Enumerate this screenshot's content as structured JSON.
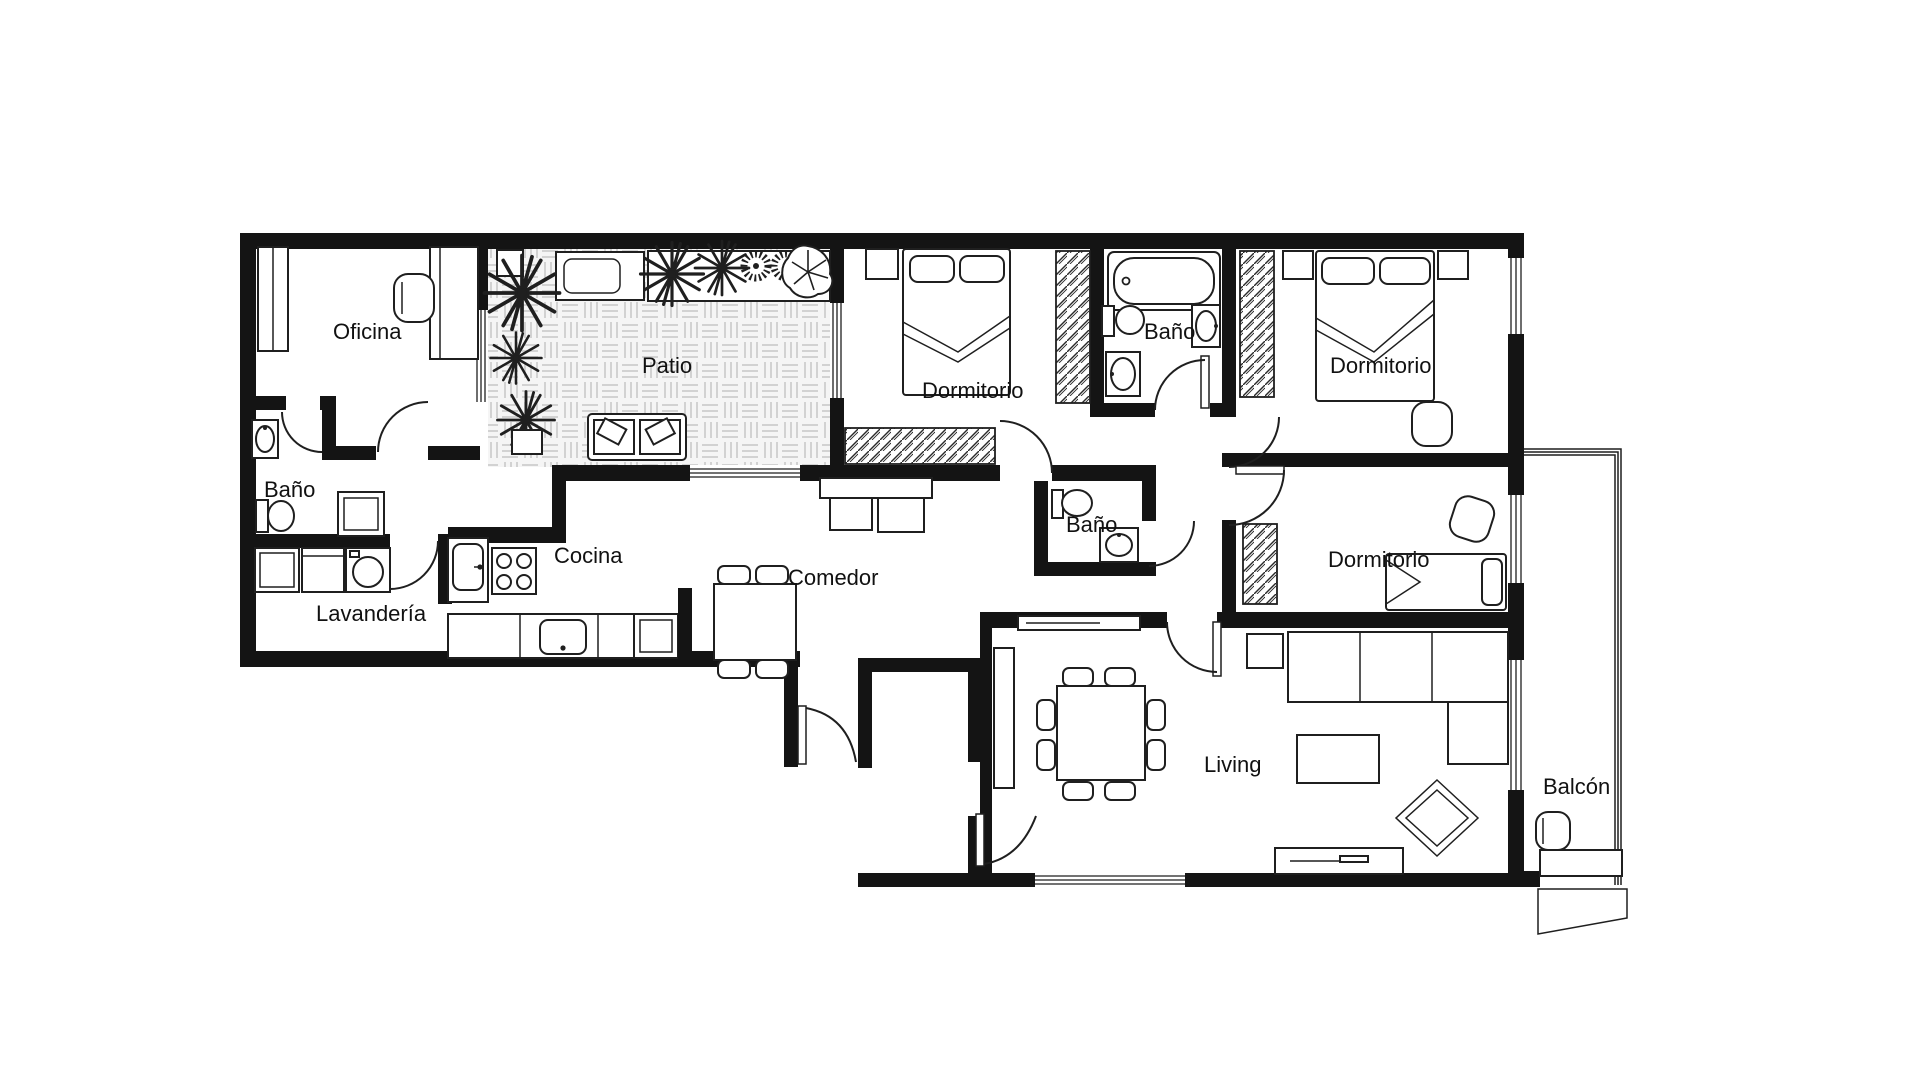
{
  "plan": {
    "rooms": {
      "oficina": {
        "label": "Oficina"
      },
      "bano_izq": {
        "label": "Baño"
      },
      "patio": {
        "label": "Patio"
      },
      "dormitorio_1": {
        "label": "Dormitorio"
      },
      "bano_sup": {
        "label": "Baño"
      },
      "dormitorio_2": {
        "label": "Dormitorio"
      },
      "lavanderia": {
        "label": "Lavandería"
      },
      "cocina": {
        "label": "Cocina"
      },
      "comedor": {
        "label": "Comedor"
      },
      "bano_med": {
        "label": "Baño"
      },
      "dormitorio_3": {
        "label": "Dormitorio"
      },
      "living": {
        "label": "Living"
      },
      "balcon": {
        "label": "Balcón"
      }
    },
    "colors": {
      "wall": "#141414",
      "line": "#1f1f1f",
      "patio_floor_line": "#c9c9c9",
      "background": "#ffffff"
    }
  }
}
